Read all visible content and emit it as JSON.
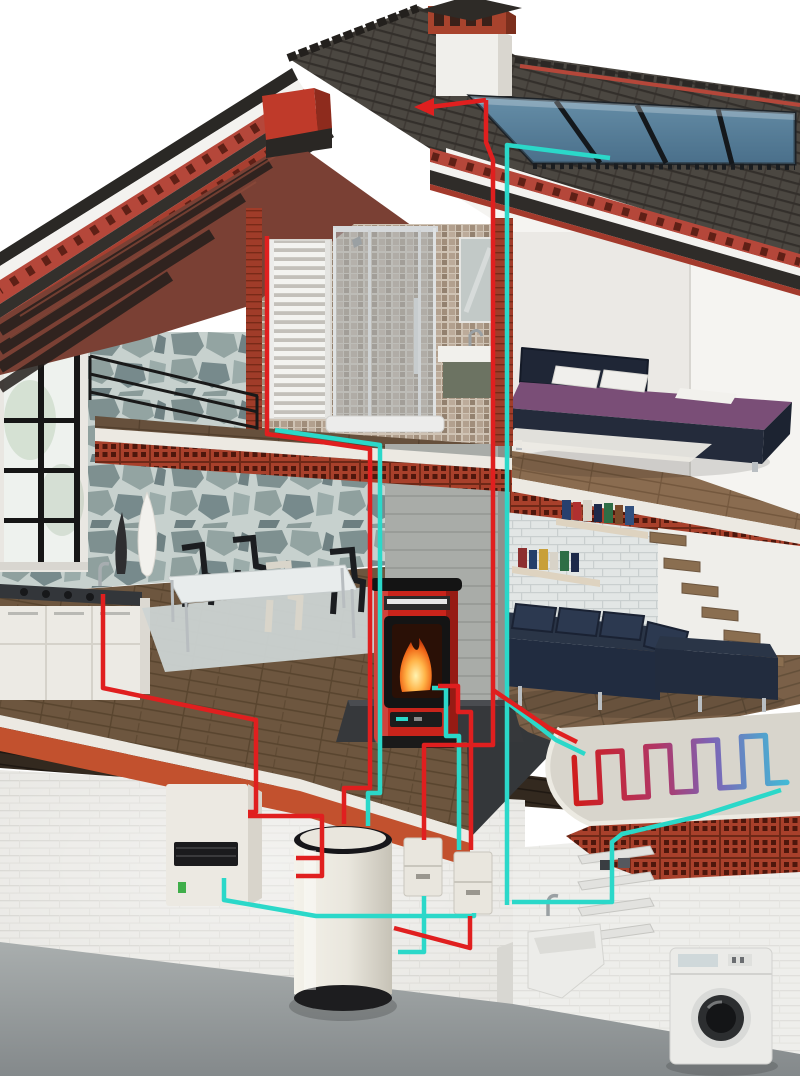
{
  "scene": {
    "name": "house-heating-system-cutaway",
    "kind": "3d-cutaway-illustration",
    "floors": [
      "attic-bathroom-bedroom",
      "main-living-floor",
      "basement-plant-room"
    ]
  },
  "palette": {
    "background": "#ffffff",
    "roof_tiles": "#4b4741",
    "roof_fascia_red": "#b5473a",
    "roof_underside_wood": "#7a4034",
    "chimney_brick": "#a8432d",
    "solar_panel": "#5d86a2",
    "stone_wall": "#8a9a99",
    "mosaic_wall": "#b3a190",
    "pipe_hot": "#e01f1f",
    "pipe_cold": "#2bd8c9",
    "stove_red": "#c9241b",
    "flame_orange": "#ff9a2a",
    "sofa_navy": "#212c40",
    "bed_frame": "#232b3c",
    "bed_cover": "#7a4e77",
    "hollow_brick": "#a8402b",
    "ledge_brick": "#c2512e",
    "appliance_white": "#ece9e2",
    "tank_white": "#e9e6dd",
    "basement_floor": "#9aa0a2",
    "wood_floor": "#6d563f",
    "rug_gray": "#ccd4d3"
  },
  "components": [
    {
      "name": "chimney"
    },
    {
      "name": "roof-tiles"
    },
    {
      "name": "solar-thermal-collector"
    },
    {
      "name": "towel-radiator"
    },
    {
      "name": "shower-cabin"
    },
    {
      "name": "bathroom-sink"
    },
    {
      "name": "bathroom-mirror"
    },
    {
      "name": "bedroom-bed"
    },
    {
      "name": "panorama-window"
    },
    {
      "name": "stone-feature-wall"
    },
    {
      "name": "kitchen-counter"
    },
    {
      "name": "dining-table"
    },
    {
      "name": "dining-chairs"
    },
    {
      "name": "pellet-stove"
    },
    {
      "name": "corner-sofa"
    },
    {
      "name": "book-shelves"
    },
    {
      "name": "floating-stairs"
    },
    {
      "name": "underfloor-heating-coil"
    },
    {
      "name": "condensing-boiler"
    },
    {
      "name": "hot-water-tank"
    },
    {
      "name": "pump-station-1"
    },
    {
      "name": "pump-station-2"
    },
    {
      "name": "utility-sink"
    },
    {
      "name": "washing-machine"
    },
    {
      "name": "hot-supply-pipes"
    },
    {
      "name": "cold-return-pipes"
    },
    {
      "name": "flow-direction-arrow"
    }
  ],
  "pipes": {
    "hot_color": "#e01f1f",
    "cold_color": "#2bd8c9",
    "coil_gradient": [
      "#cf1d1d",
      "#b03767",
      "#7d63b5",
      "#43b9d6"
    ]
  }
}
